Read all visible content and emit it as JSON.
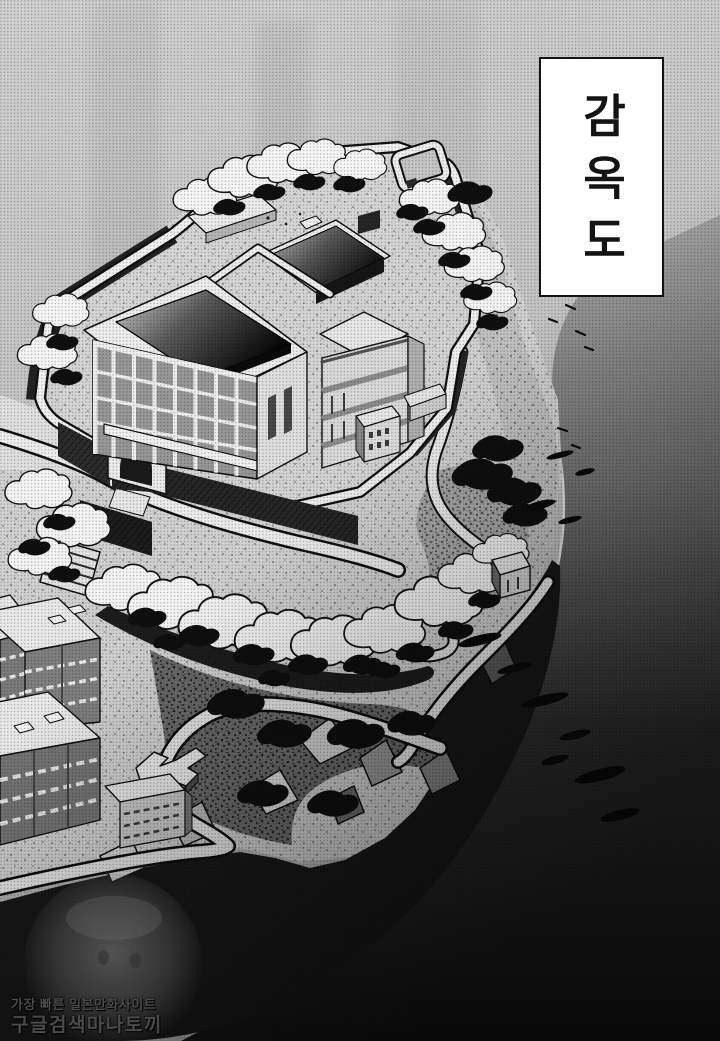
{
  "title_box": {
    "text": "감옥도"
  },
  "watermark": {
    "line1": "가장 빠른 일본만화사이트",
    "line2": "구글검색마나토끼"
  },
  "palette": {
    "paper": "#cbcbcb",
    "ink": "#141414",
    "box_bg": "#ffffff",
    "wm_text": "#4a4a4a",
    "water_top": "#a6a6a6",
    "water_bottom": "#131313",
    "building_light": "#f2f2f2",
    "roof_dark": "#0a0a0a",
    "wall_dark": "#262626",
    "ground": "#d6d6d6"
  }
}
